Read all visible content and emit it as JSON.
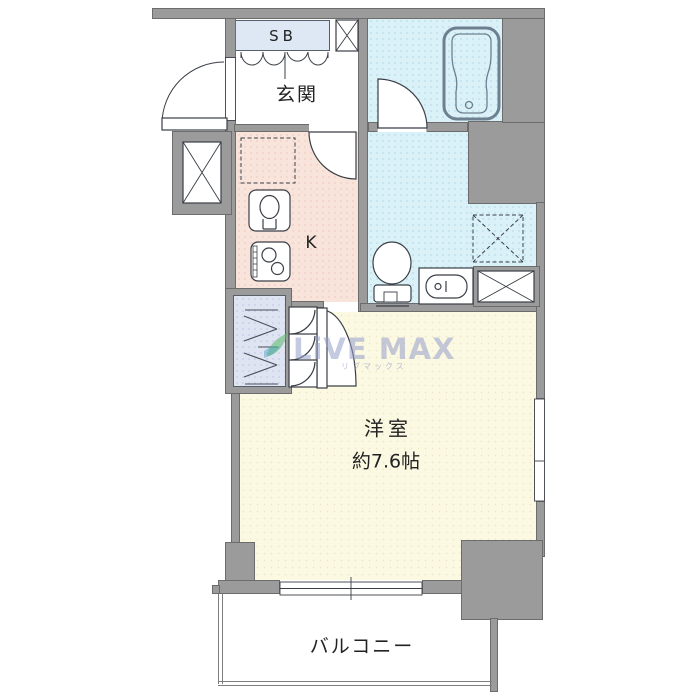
{
  "plan": {
    "labels": {
      "shoe_box": "SB",
      "entrance": "玄関",
      "kitchen": "K",
      "room_name": "洋室",
      "room_size": "約7.6帖",
      "balcony": "バルコニー"
    },
    "watermark": {
      "brand": "LiVE MAX",
      "kana": "リブマックス"
    },
    "colors": {
      "wall": "#9b9b9b",
      "wall_outline": "#6c6c6c",
      "wet_area": "#daf1f8",
      "kitchen": "#f8e4db",
      "main_room": "#fcf9e2",
      "closet": "#dfe4f2",
      "shoe_box": "#dde8f4",
      "linework": "#3a3f47",
      "watermark_text": "#949ECA",
      "watermark_leaf": "#58b868"
    }
  }
}
